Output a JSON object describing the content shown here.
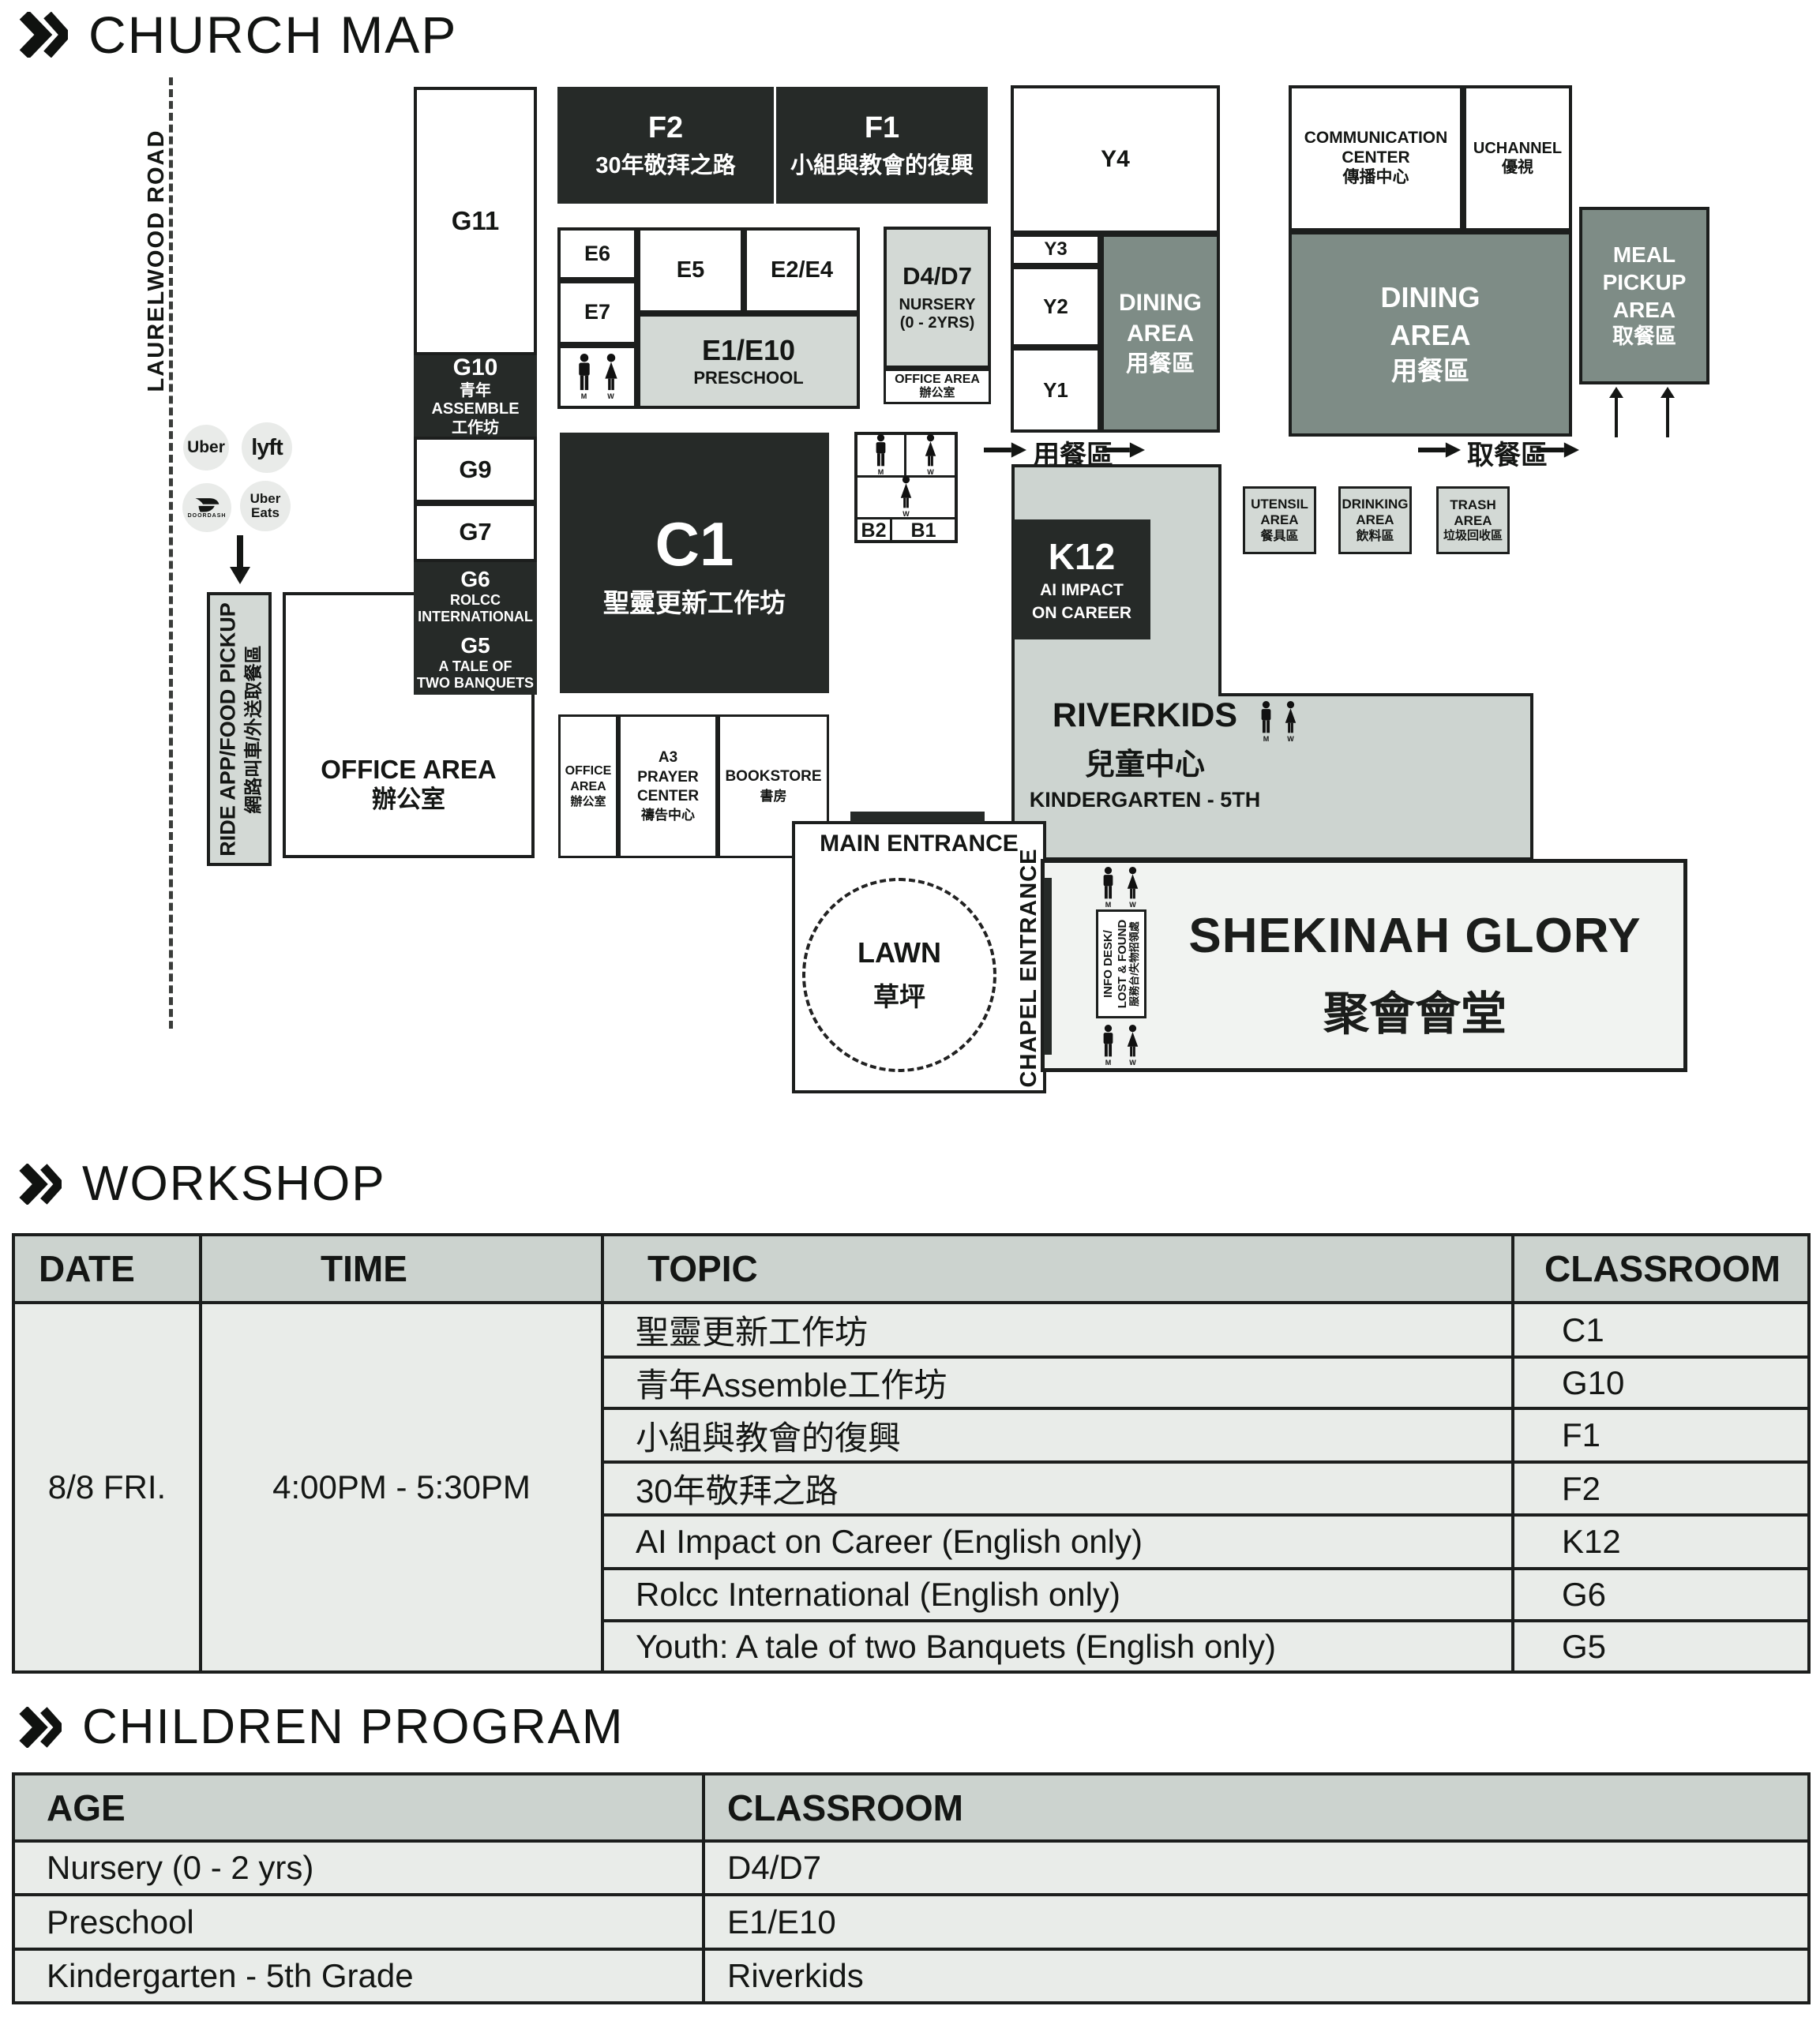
{
  "titles": {
    "map": "CHURCH MAP",
    "workshop": "WORKSHOP",
    "children": "CHILDREN PROGRAM"
  },
  "colors": {
    "dark_room": "#262a28",
    "dining_area": "#7e8c86",
    "light_area": "#d3d9d5",
    "table_header": "#ccd3cf",
    "table_row": "#e9ece9",
    "shekinah_fill": "#f1f3f1"
  },
  "map": {
    "road": "LAURELWOOD ROAD",
    "ride": {
      "uber": "Uber",
      "lyft": "lyft",
      "doordash": "DOORDASH",
      "ubereats1": "Uber",
      "ubereats2": "Eats"
    },
    "ride_pickup": {
      "en": "RIDE APP/FOOD PICKUP",
      "zh": "網路叫車/外送取餐區"
    },
    "flow": {
      "dining": "用餐區",
      "pickup": "取餐區"
    },
    "restroom": {
      "m": "M",
      "w": "W"
    },
    "rooms": {
      "g11": "G11",
      "g10": {
        "id": "G10",
        "zh1": "青年ASSEMBLE",
        "zh2": "工作坊"
      },
      "g9": "G9",
      "g7": "G7",
      "g6": {
        "id": "G6",
        "l1": "ROLCC",
        "l2": "INTERNATIONAL"
      },
      "g5": {
        "id": "G5",
        "l1": "A TALE OF",
        "l2": "TWO BANQUETS"
      },
      "f2": {
        "id": "F2",
        "zh": "30年敬拜之路"
      },
      "f1": {
        "id": "F1",
        "zh": "小組與教會的復興"
      },
      "e6": "E6",
      "e7": "E7",
      "e5": "E5",
      "e24": "E2/E4",
      "e110": {
        "id": "E1/E10",
        "sub": "PRESCHOOL"
      },
      "d47": {
        "id": "D4/D7",
        "l1": "NURSERY",
        "l2": "(0 - 2YRS)"
      },
      "d_office": {
        "l1": "OFFICE AREA",
        "l2": "辦公室"
      },
      "c1": {
        "id": "C1",
        "zh": "聖靈更新工作坊"
      },
      "b2": "B2",
      "b1": "B1",
      "y4": "Y4",
      "y3": "Y3",
      "y2": "Y2",
      "y1": "Y1",
      "dining1": {
        "l1": "DINING",
        "l2": "AREA",
        "zh": "用餐區"
      },
      "dining2": {
        "l1": "DINING",
        "l2": "AREA",
        "zh": "用餐區"
      },
      "comm": {
        "l1": "COMMUNICATION",
        "l2": "CENTER",
        "zh": "傳播中心"
      },
      "uchannel": {
        "l1": "UCHANNEL",
        "zh": "優視"
      },
      "meal": {
        "l1": "MEAL",
        "l2": "PICKUP",
        "l3": "AREA",
        "zh": "取餐區"
      },
      "utensil": {
        "l1": "UTENSIL",
        "l2": "AREA",
        "zh": "餐具區"
      },
      "drinking": {
        "l1": "DRINKING",
        "l2": "AREA",
        "zh": "飲料區"
      },
      "trash": {
        "l1": "TRASH",
        "l2": "AREA",
        "zh": "垃圾回收區"
      },
      "k12": {
        "id": "K12",
        "l1": "AI IMPACT",
        "l2": "ON CAREER"
      },
      "riverkids": {
        "l1": "RIVERKIDS",
        "zh": "兒童中心",
        "l2": "KINDERGARTEN - 5TH"
      },
      "office_big": {
        "l1": "OFFICE AREA",
        "l2": "辦公室"
      },
      "office_small": {
        "l1": "OFFICE",
        "l2": "AREA",
        "zh": "辦公室"
      },
      "a3": {
        "l1": "A3",
        "l2": "PRAYER",
        "l3": "CENTER",
        "zh": "禱告中心"
      },
      "bookstore": {
        "l1": "BOOKSTORE",
        "zh": "書房"
      },
      "main_entrance": "MAIN ENTRANCE",
      "lawn": {
        "l1": "LAWN",
        "zh": "草坪"
      },
      "chapel": "CHAPEL ENTRANCE",
      "infodesk": {
        "l1": "INFO DESK/",
        "l2": "LOST & FOUND",
        "zh": "服務台/失物招領處"
      },
      "shekinah": {
        "l1": "SHEKINAH GLORY",
        "zh": "聚會會堂"
      }
    }
  },
  "workshop": {
    "headers": {
      "date": "DATE",
      "time": "TIME",
      "topic": "TOPIC",
      "classroom": "CLASSROOM"
    },
    "date": "8/8 FRI.",
    "time": "4:00PM - 5:30PM",
    "rows": [
      {
        "topic": "聖靈更新工作坊",
        "classroom": "C1"
      },
      {
        "topic": "青年Assemble工作坊",
        "classroom": "G10"
      },
      {
        "topic": "小組與教會的復興",
        "classroom": "F1"
      },
      {
        "topic": "30年敬拜之路",
        "classroom": "F2"
      },
      {
        "topic": "AI Impact on Career (English only)",
        "classroom": "K12"
      },
      {
        "topic": "Rolcc International (English only)",
        "classroom": "G6"
      },
      {
        "topic": "Youth: A tale of two Banquets (English only)",
        "classroom": "G5"
      }
    ]
  },
  "children": {
    "headers": {
      "age": "AGE",
      "classroom": "CLASSROOM"
    },
    "rows": [
      {
        "age": "Nursery (0 - 2 yrs)",
        "classroom": "D4/D7"
      },
      {
        "age": "Preschool",
        "classroom": "E1/E10"
      },
      {
        "age": "Kindergarten - 5th Grade",
        "classroom": "Riverkids"
      }
    ]
  }
}
